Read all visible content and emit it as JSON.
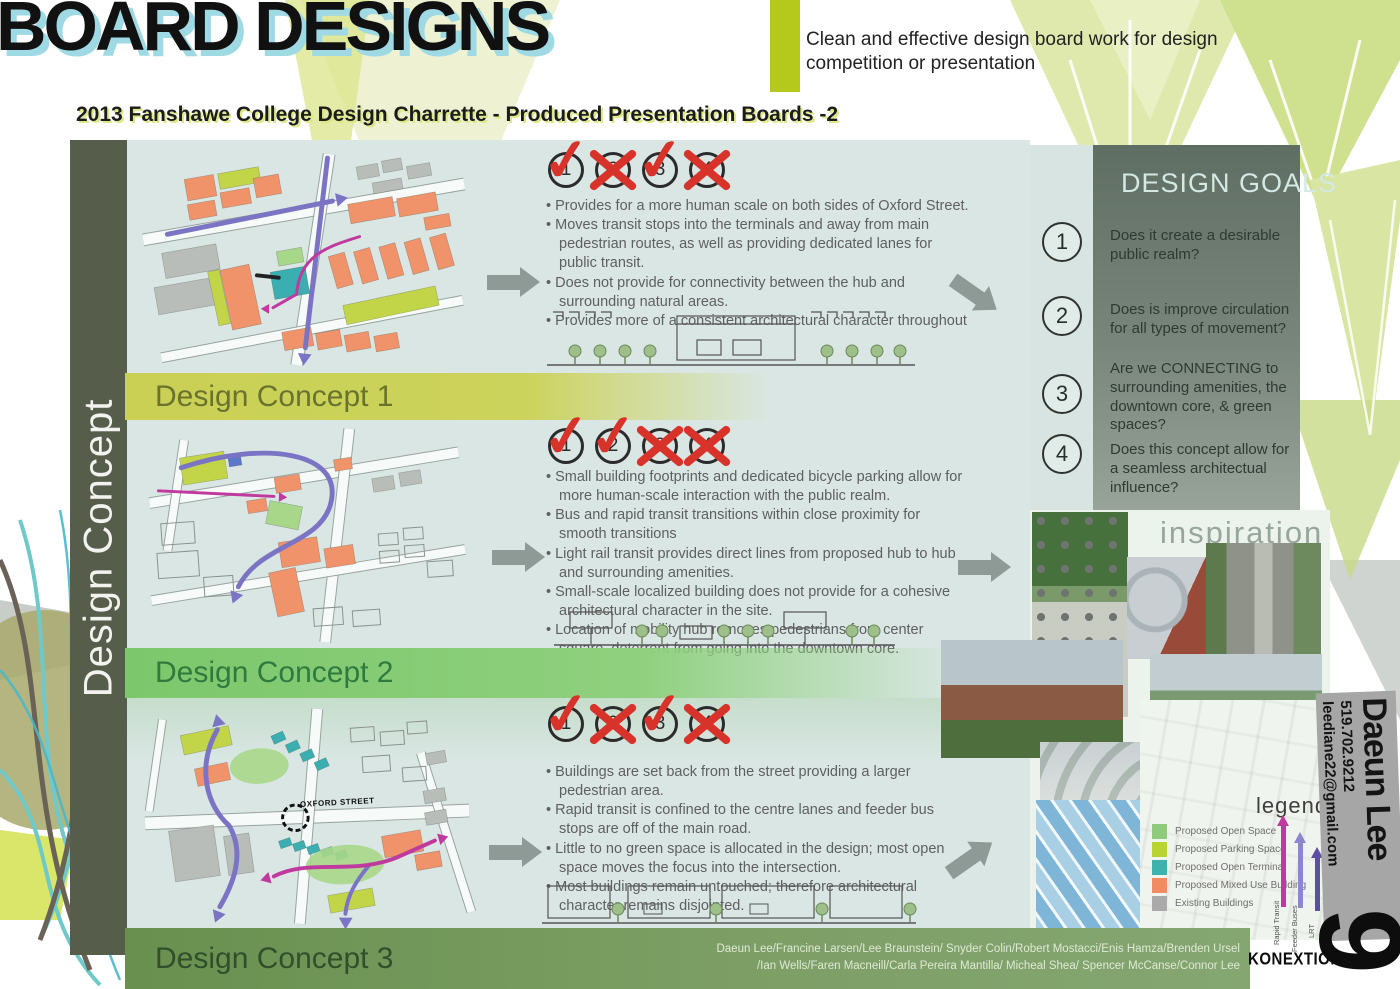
{
  "page": {
    "title": "BOARD DESIGNS",
    "subtitle": "2013 Fanshawe College Design Charrette - Produced Presentation Boards -2",
    "tagline_line1": "Clean and effective design board work for design",
    "tagline_line2": "competition or presentation"
  },
  "sidebar": {
    "label": "Design Concept"
  },
  "rating_numbers": [
    "1",
    "2",
    "3",
    "4"
  ],
  "concepts": [
    {
      "title": "Design Concept 1",
      "marks": [
        "check",
        "cross",
        "check",
        "cross"
      ],
      "bullets": [
        "Provides for a more human scale on both sides of Oxford Street.",
        "Moves transit stops into the terminals and away from main pedestrian routes, as well as providing dedicated lanes for public transit.",
        "Does not provide for connectivity between the hub and surrounding natural areas.",
        "Provides more of a consistent architectural character throughout"
      ]
    },
    {
      "title": "Design Concept 2",
      "marks": [
        "check",
        "check",
        "cross",
        "cross"
      ],
      "bullets": [
        "Small building footprints and dedicated bicycle parking allow for more human-scale interaction with the public realm.",
        "Bus and rapid transit transitions within close proximity for smooth transitions",
        "Light rail transit provides direct lines from proposed hub to hub and surrounding amenities.",
        "Small-scale localized building does not provide for a cohesive architectural character in the site.",
        "Location of mobility hub removes pedestrians from center square, deterrent from going into the downtown core."
      ]
    },
    {
      "title": "Design Concept 3",
      "marks": [
        "check",
        "cross",
        "check",
        "cross"
      ],
      "bullets": [
        "Buildings are set back from the street providing a larger pedestrian area.",
        "Rapid transit is confined to the centre lanes and feeder bus stops are off of the main road.",
        "Little to no green space is allocated in the design; most open space moves the focus into the intersection.",
        "Most buildings remain untouched; therefore architectural character remains disjointed."
      ]
    }
  ],
  "design_goals": {
    "title": "DESIGN GOALS",
    "items": [
      {
        "num": "1",
        "text": "Does it create a desirable public realm?"
      },
      {
        "num": "2",
        "text": "Does is improve circulation for all types of movement?"
      },
      {
        "num": "3",
        "text": "Are we CONNECTING to surrounding amenities, the downtown core, & green spaces?"
      },
      {
        "num": "4",
        "text": "Does this concept allow for a seamless architectual influence?"
      }
    ]
  },
  "inspiration_label": "inspiration",
  "legend": {
    "title": "legend",
    "items": [
      {
        "label": "Proposed Open Space",
        "color": "#8fcb7d"
      },
      {
        "label": "Proposed Parking Space",
        "color": "#b9d42e"
      },
      {
        "label": "Proposed Open Terminal",
        "color": "#3db3ae"
      },
      {
        "label": "Proposed Mixed Use Building",
        "color": "#f28a62"
      },
      {
        "label": "Existing Buildings",
        "color": "#a9aaa9"
      }
    ],
    "arrows": [
      {
        "label": "Rapid Transit",
        "color": "#c0399f"
      },
      {
        "label": "Feeder Buses",
        "color": "#8d85cd"
      },
      {
        "label": "LRT",
        "color": "#5a4fa0"
      }
    ]
  },
  "map_labels": {
    "street": "OXFORD STREET"
  },
  "contact": {
    "name": "Daeun Lee",
    "email": "leediane22@gmail.com",
    "phone": "519.702.9212",
    "board_number": "9"
  },
  "credits": {
    "line1": "Daeun Lee/Francine Larsen/Lee Braunstein/ Snyder Colin/Robert Mostacci/Enis Hamza/Brenden Ursel",
    "line2": "/Ian Wells/Faren Macneill/Carla Pereira Mantilla/ Micheal Shea/ Spencer McCanse/Connor Lee"
  },
  "logo": "KONEXTION",
  "colors": {
    "title_shadow": "#9ed9e4",
    "tagline_block": "#b5c91c",
    "sidebar_bg": "#565d4b",
    "row_bg": "#d9e6e3",
    "band1": "#c9d054",
    "band2": "#7fc96e",
    "band3": "#6e9253",
    "goals_panel": "#66756a",
    "mark_red": "#d7332a"
  }
}
